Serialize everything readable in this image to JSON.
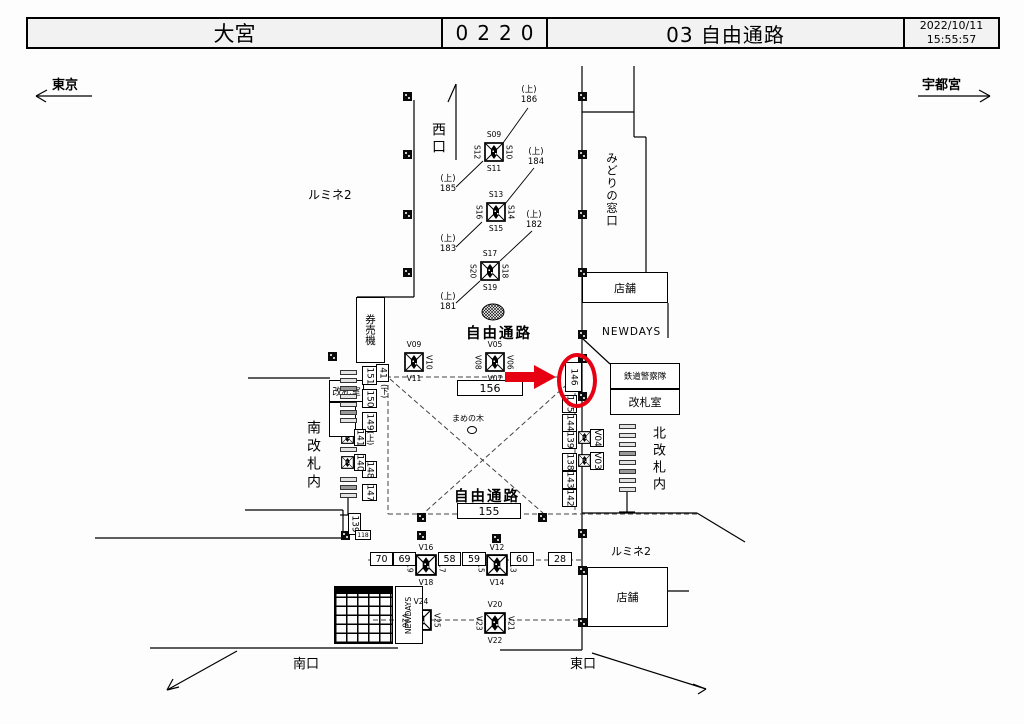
{
  "header": {
    "station": "大宮",
    "code": "0220",
    "title": "03 自由通路",
    "date": "2022/10/11",
    "time": "15:55:57"
  },
  "nav": {
    "left": "東京",
    "right": "宇都宮"
  },
  "areas": {
    "lumine2_top": "ルミネ2",
    "west_exit": "西口",
    "midori_madoguchi": "みどりの窓口",
    "shop_right": "店舗",
    "newdays_right": "NEWDAYS",
    "railway_police": "鉄道警察隊",
    "gate_office_right": "改札室",
    "north_gate_inside": "北改札内",
    "south_gate_inside": "南改札内",
    "ticket_machines": "券売機",
    "gate_office_left": "改札室",
    "passage_upper": "自由通路",
    "passage_lower": "自由通路",
    "mamenoki": "まめの木",
    "lumine2_bottom": "ルミネ2",
    "shop_bottom": "店舗",
    "newdays_bottom": "NEWDAYS",
    "south_exit": "南口",
    "east_exit": "東口"
  },
  "upper_cams": {
    "u186": {
      "level": "(上)",
      "num": "186"
    },
    "u185": {
      "level": "(上)",
      "num": "185"
    },
    "u184": {
      "level": "(上)",
      "num": "184"
    },
    "u183": {
      "level": "(上)",
      "num": "183"
    },
    "u182": {
      "level": "(上)",
      "num": "182"
    },
    "u181": {
      "level": "(上)",
      "num": "181"
    }
  },
  "cams": {
    "s09": "S09",
    "s10": "S10",
    "s11": "S11",
    "s12": "S12",
    "s13": "S13",
    "s14": "S14",
    "s15": "S15",
    "s16": "S16",
    "s17": "S17",
    "s18": "S18",
    "s19": "S19",
    "s20": "S20",
    "v03": "V03",
    "v04": "V04",
    "v05": "V05",
    "v06": "V06",
    "v07": "V07",
    "v08": "V08",
    "v09": "V09",
    "v10": "V10",
    "v11": "V11",
    "v12": "V12",
    "v13": "V13",
    "v14": "V14",
    "v15": "V15",
    "v16": "V16",
    "v17": "V17",
    "v18": "V18",
    "v19": "V19",
    "v20": "V20",
    "v21": "V21",
    "v22": "V22",
    "v23": "V23",
    "v24": "V24",
    "v25": "V25",
    "v26": "V26"
  },
  "boxes": {
    "n156": "156",
    "n155": "155",
    "r146": "146",
    "r145": "145",
    "r144": "144",
    "r139": "139",
    "r138": "138",
    "r143": "143",
    "r142": "142",
    "l151": "151",
    "l150": "150",
    "l149": "149",
    "l148": "148",
    "l147": "147",
    "g141": "141",
    "g140": "140",
    "bl139": "139",
    "bl118": "118",
    "b70": "70",
    "b69": "69",
    "b58": "58",
    "b59": "59",
    "b60": "60",
    "b28": "28",
    "s41": "41"
  },
  "marks": {
    "down": "(下)",
    "up": "(上)"
  },
  "highlight": {
    "color": "#e60012",
    "target": "146"
  }
}
